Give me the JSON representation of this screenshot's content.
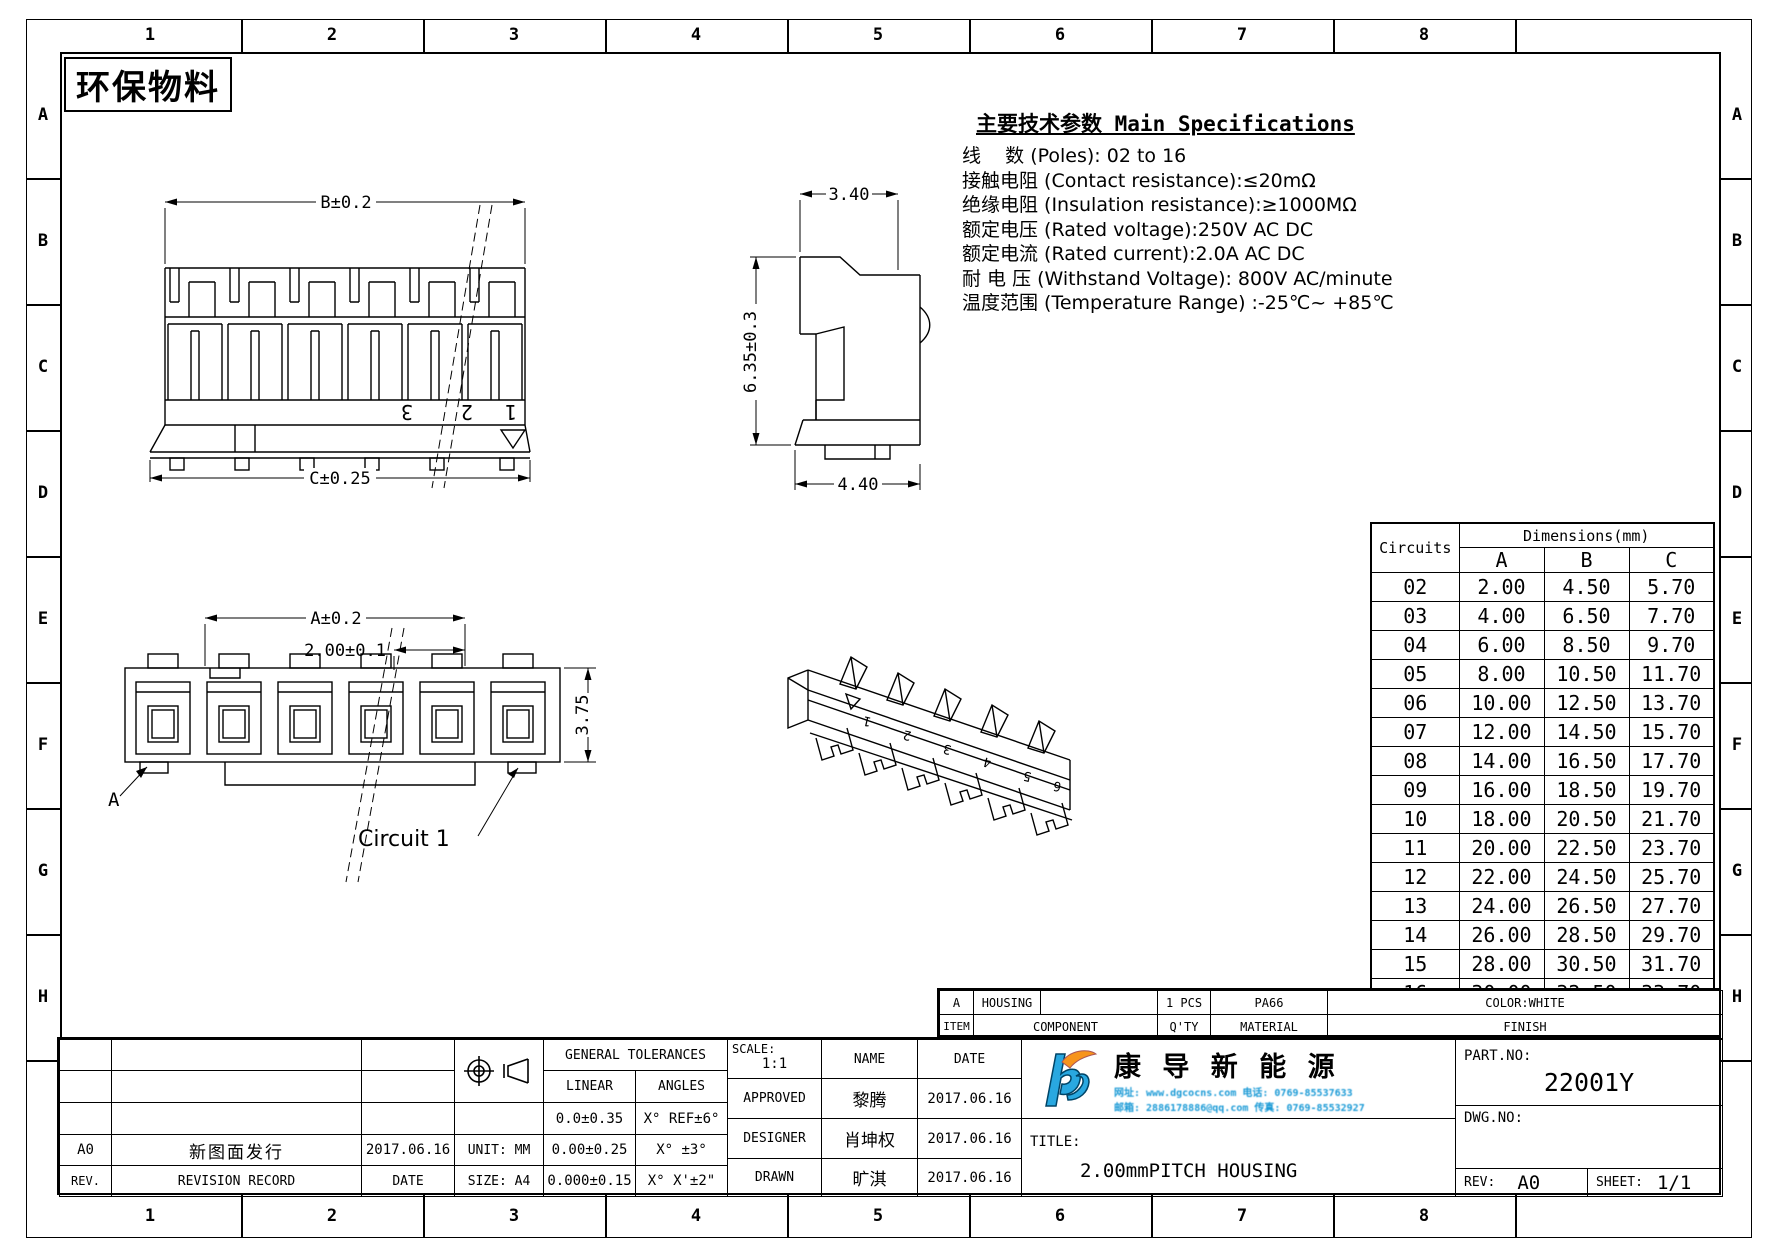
{
  "eco_label": "环保物料",
  "zones": {
    "columns": [
      "1",
      "2",
      "3",
      "4",
      "5",
      "6",
      "7",
      "8"
    ],
    "rows": [
      "A",
      "B",
      "C",
      "D",
      "E",
      "F",
      "G",
      "H"
    ]
  },
  "specs": {
    "title": "主要技术参数 Main Specifications",
    "lines": [
      "线    数 (Poles): 02 to 16",
      "接触电阻 (Contact resistance):≤20mΩ",
      "绝缘电阻 (Insulation resistance):≥1000MΩ",
      "额定电压 (Rated voltage):250V AC DC",
      "额定电流 (Rated current):2.0A AC DC",
      "耐 电 压 (Withstand Voltage): 800V AC/minute",
      "温度范围 (Temperature Range) :-25℃~ +85℃"
    ]
  },
  "views": {
    "front": {
      "dim_width_top": "B±0.2",
      "dim_width_bottom": "C±0.25",
      "pin_labels": [
        "3",
        "2",
        "1"
      ]
    },
    "side": {
      "dim_top": "3.40",
      "dim_height": "6.35±0.3",
      "dim_bottom": "4.40"
    },
    "bottom": {
      "dim_width": "A±0.2",
      "dim_pitch": "2.00±0.1",
      "dim_height": "3.75",
      "section_label": "A",
      "circuit_label": "Circuit 1"
    },
    "iso": {
      "pin_labels": [
        "1",
        "2",
        "3",
        "4",
        "5",
        "6"
      ]
    }
  },
  "dim_table": {
    "col0": "Circuits",
    "header": "Dimensions(mm)",
    "cols": [
      "A",
      "B",
      "C"
    ],
    "rows": [
      [
        "02",
        "2.00",
        "4.50",
        "5.70"
      ],
      [
        "03",
        "4.00",
        "6.50",
        "7.70"
      ],
      [
        "04",
        "6.00",
        "8.50",
        "9.70"
      ],
      [
        "05",
        "8.00",
        "10.50",
        "11.70"
      ],
      [
        "06",
        "10.00",
        "12.50",
        "13.70"
      ],
      [
        "07",
        "12.00",
        "14.50",
        "15.70"
      ],
      [
        "08",
        "14.00",
        "16.50",
        "17.70"
      ],
      [
        "09",
        "16.00",
        "18.50",
        "19.70"
      ],
      [
        "10",
        "18.00",
        "20.50",
        "21.70"
      ],
      [
        "11",
        "20.00",
        "22.50",
        "23.70"
      ],
      [
        "12",
        "22.00",
        "24.50",
        "25.70"
      ],
      [
        "13",
        "24.00",
        "26.50",
        "27.70"
      ],
      [
        "14",
        "26.00",
        "28.50",
        "29.70"
      ],
      [
        "15",
        "28.00",
        "30.50",
        "31.70"
      ],
      [
        "16",
        "30.00",
        "32.50",
        "33.70"
      ]
    ]
  },
  "component_table": {
    "row1": [
      "A",
      "HOUSING",
      "",
      "1 PCS",
      "PA66",
      "COLOR:WHITE"
    ],
    "row2": [
      "ITEM",
      "COMPONENT",
      "Q'TY",
      "MATERIAL",
      "FINISH"
    ]
  },
  "title_block": {
    "rev_value": "A0",
    "rev_desc": "新图面发行",
    "rev_date": "2017.06.16",
    "rev_label": "REV.",
    "record_label": "REVISION RECORD",
    "date_label": "DATE",
    "unit_label": "UNIT: MM",
    "size_label": "SIZE: A4",
    "general_tolerances": "GENERAL TOLERANCES",
    "linear_label": "LINEAR",
    "angles_label": "ANGLES",
    "linear_values": [
      "0.0±0.35",
      "0.00±0.25",
      "0.000±0.15"
    ],
    "angle_values": [
      "X° REF±6°",
      "X° ±3°",
      "X° X'±2\""
    ],
    "scale_label": "SCALE:",
    "scale_value": "1:1",
    "name_label": "NAME",
    "date_col_label": "DATE",
    "approved_label": "APPROVED",
    "approved_name": "黎腾",
    "approved_date": "2017.06.16",
    "designer_label": "DESIGNER",
    "designer_name": "肖坤权",
    "designer_date": "2017.06.16",
    "drawn_label": "DRAWN",
    "drawn_name": "旷淇",
    "drawn_date": "2017.06.16",
    "title_label": "TITLE:",
    "title_value": "2.00mmPITCH HOUSING",
    "part_no_label": "PART.NO:",
    "part_no": "22001Y",
    "dwg_no_label": "DWG.NO:",
    "rev_field_label": "REV:",
    "rev_field": "A0",
    "sheet_label": "SHEET:",
    "sheet": "1/1"
  },
  "logo": {
    "company": "康  导  新  能  源",
    "contact1": "网址: www.dgcocns.com   电话: 0769-85537633",
    "contact2": "邮箱: 2886178886@qq.com 传真: 0769-85532927"
  }
}
